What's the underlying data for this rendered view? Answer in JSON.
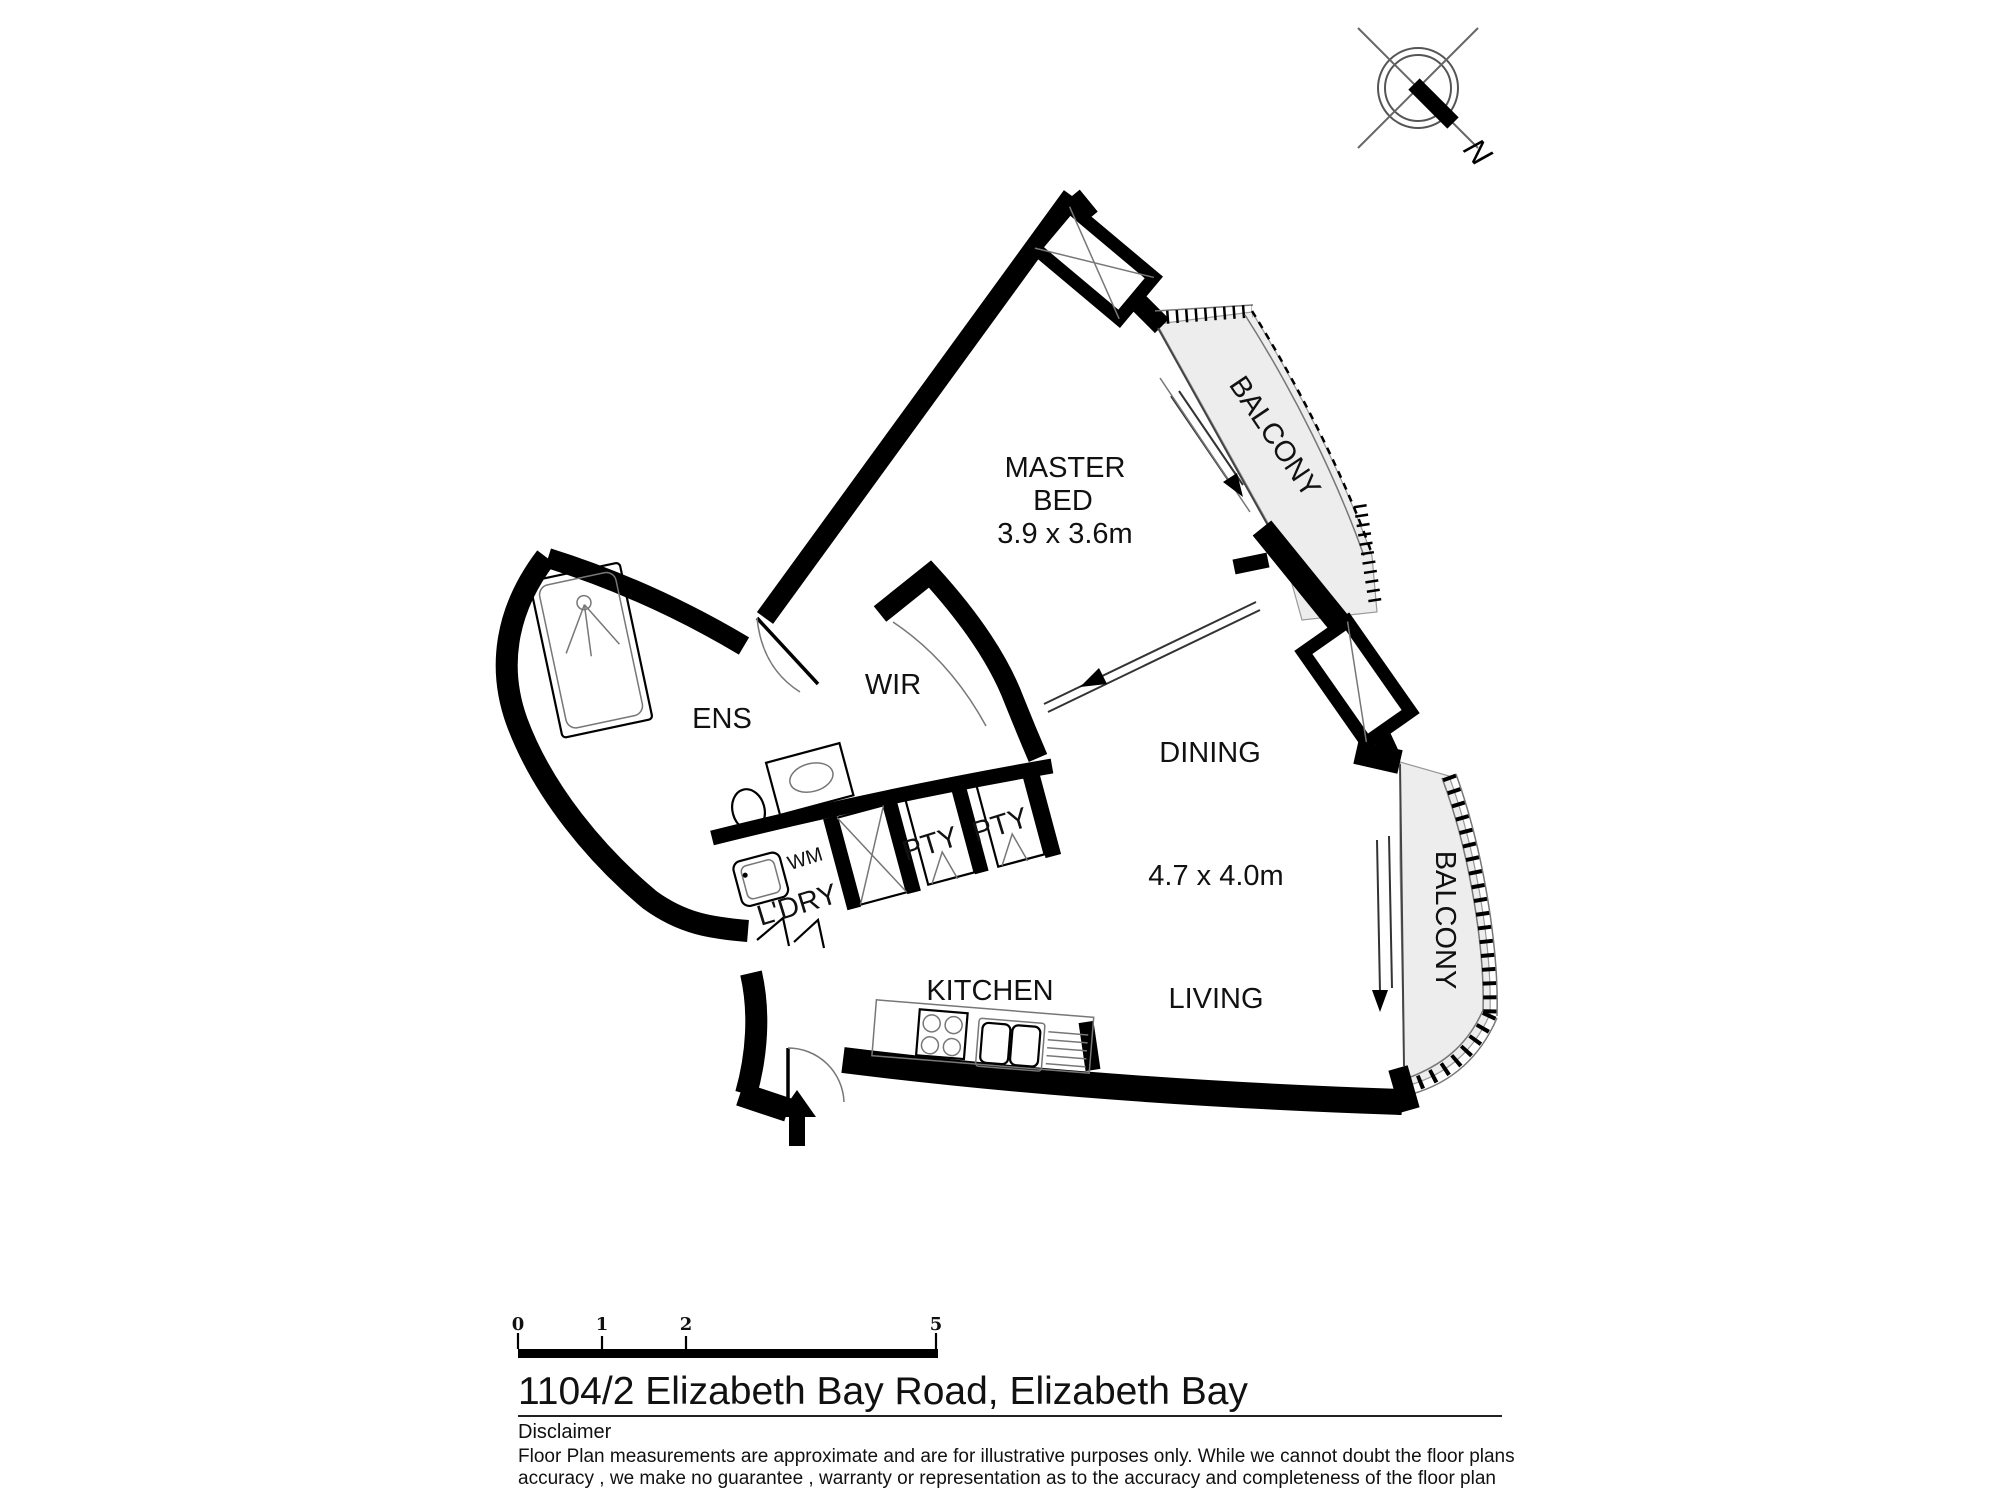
{
  "compass": {
    "north_label": "N"
  },
  "plan": {
    "rooms": {
      "master_bed": {
        "name_line1": "MASTER",
        "name_line2": "BED",
        "dimensions": "3.9 x 3.6m"
      },
      "dining": {
        "name": "DINING",
        "dimensions": "4.7 x 4.0m"
      },
      "living": {
        "name": "LIVING"
      },
      "kitchen": {
        "name": "KITCHEN"
      },
      "ens": {
        "name": "ENS"
      },
      "wir": {
        "name": "WIR"
      },
      "laundry": {
        "name": "L'DRY",
        "appliance": "WM"
      },
      "pantry1": {
        "name": "PTY"
      },
      "pantry2": {
        "name": "PTY"
      },
      "balcony_top": {
        "name": "BALCONY"
      },
      "balcony_right": {
        "name": "BALCONY"
      }
    }
  },
  "scale_bar": {
    "ticks": [
      "0",
      "1",
      "2",
      "5"
    ]
  },
  "footer": {
    "title": "1104/2 Elizabeth Bay Road, Elizabeth Bay",
    "disclaimer_heading": "Disclaimer",
    "disclaimer_line1": "Floor Plan measurements are approximate and are for illustrative purposes only. While we cannot doubt the floor plans",
    "disclaimer_line2": "accuracy , we make no guarantee , warranty or representation as to the accuracy and completeness of the floor plan"
  },
  "colors": {
    "wall": "#000000",
    "balcony_fill": "#ededed",
    "background": "#ffffff"
  }
}
